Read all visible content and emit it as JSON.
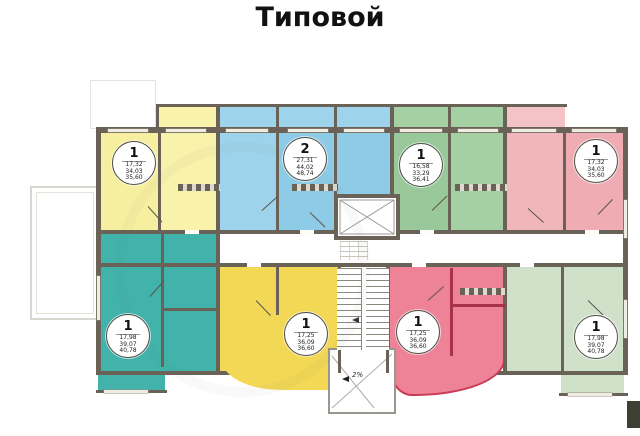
{
  "title": "Типовой",
  "ramp": {
    "label": "2%"
  },
  "colors": {
    "wall": "#6a6257",
    "yellow_top": "#f6efa0",
    "yellow_bottom": "#f2d855",
    "blue": "#8ecbe7",
    "green_top": "#99c99a",
    "pink": "#f1b6ba",
    "teal": "#41b3aa",
    "red_selected": "#ee8296",
    "red_outline": "#c93a55",
    "green_pale": "#cfe1c9",
    "window": "#efece3"
  },
  "apartments": [
    {
      "name": "top-left-yellow",
      "badge": "1",
      "areas": [
        "17,32",
        "34,03",
        "35,60"
      ]
    },
    {
      "name": "top-blue",
      "badge": "2",
      "areas": [
        "27,31",
        "44,02",
        "48,74"
      ]
    },
    {
      "name": "top-green",
      "badge": "1",
      "areas": [
        "16,58",
        "33,29",
        "36,41"
      ]
    },
    {
      "name": "top-right-pink",
      "badge": "1",
      "areas": [
        "17,32",
        "34,03",
        "35,60"
      ]
    },
    {
      "name": "bottom-left-teal",
      "badge": "1",
      "areas": [
        "17,98",
        "39,07",
        "40,78"
      ]
    },
    {
      "name": "bottom-yellow",
      "badge": "1",
      "areas": [
        "17,25",
        "36,09",
        "36,60"
      ]
    },
    {
      "name": "bottom-red-selected",
      "badge": "1",
      "areas": [
        "17,25",
        "36,09",
        "36,60"
      ],
      "highlighted": true
    },
    {
      "name": "bottom-right-green",
      "badge": "1",
      "areas": [
        "17,98",
        "39,07",
        "40,78"
      ]
    }
  ]
}
